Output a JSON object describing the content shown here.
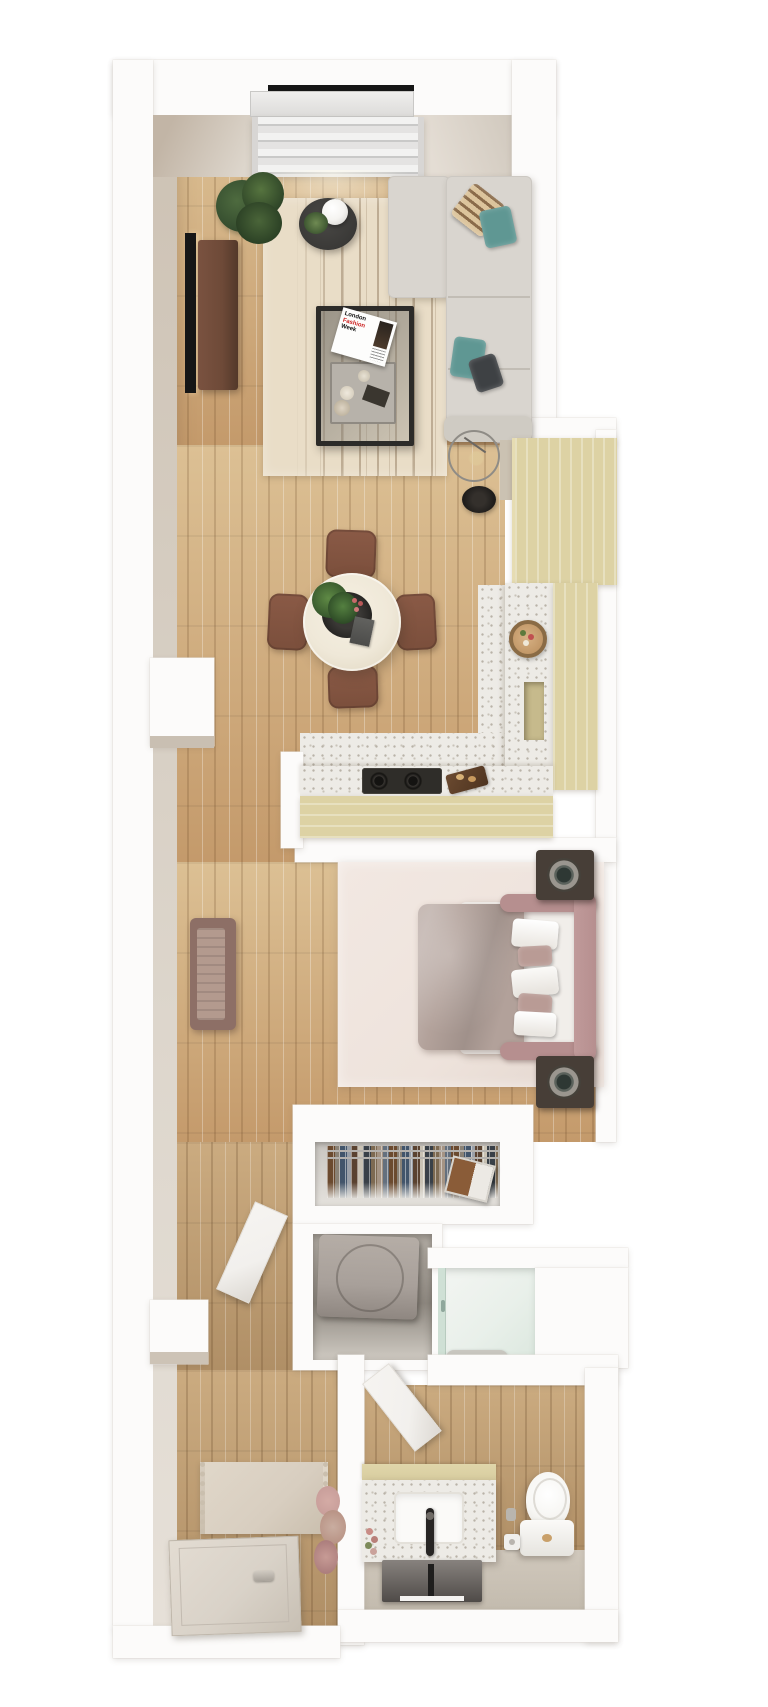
{
  "scene": {
    "description": "3D top-down rendered floor plan of a narrow one-bedroom apartment"
  },
  "magazine": {
    "line1": "London",
    "line2": "Fashion",
    "line3": "Week"
  },
  "colors": {
    "wall": "#fcfbfa",
    "wall_face": "#c2b5a6",
    "wall_face_light": "#ddd6cc",
    "wood_a": "#dcc094",
    "wood_b": "#c49a6b",
    "wood2_a": "#cbab80",
    "wood2_b": "#b08f66",
    "terrazzo": "#edebe6",
    "terrazzo_dot": "#b9b3a8",
    "rug_living": "#e9ddc7",
    "rug_stripe": "#7d6647",
    "sofa": "#d9d5cf",
    "pillow_teal": "#5f9793",
    "pillow_stripe_a": "#dcc49c",
    "pillow_stripe_b": "#8a6b4a",
    "pillow_dark": "#3e4144",
    "side_table": "#3a3937",
    "lamp_white": "#f5f4f1",
    "tv": "#161616",
    "console": "#6e4a38",
    "dining_table": "#efe8d8",
    "chair": "#7b4f3c",
    "cabinet": "#ddd2a4",
    "cabinet_light": "#e6dcb2",
    "cooktop": "#2f2d29",
    "bed_frame": "#b68f8f",
    "duvet": "#b2a19a",
    "sheet": "#f1eeea",
    "pillow_mauve": "#b99b95",
    "rug_bedroom": "#eee3dc",
    "speaker": "#473e37",
    "speaker_cone": "#9a968f",
    "bench": "#8d6f66",
    "bench_top": "#b39a8e",
    "washer": "#a8a09a",
    "shower_glass": "#cfe0d5",
    "shower_floor": "#e9f0ea",
    "mat": "#c9c7c0",
    "bath_floor_low": "#d0c8bc",
    "toilet": "#f7f6f3",
    "mirror_a": "#87827e",
    "mirror_b": "#4f4b48",
    "entry_rug": "#d8cec0",
    "pampas": "#c99f9b",
    "door": "#f2f0ed",
    "entry_door": "#d9d2c8",
    "plant_dark": "#31482c",
    "plant_mid": "#4e6b3f"
  },
  "rooms": [
    {
      "id": "living-room",
      "items": [
        "window-with-blinds",
        "large-plant",
        "round-side-table",
        "sphere-lamp",
        "wall-tv",
        "tv-console",
        "sectional-sofa",
        "throw-pillows",
        "striped-area-rug",
        "glass-coffee-table",
        "magazine",
        "serving-tray",
        "wire-floor-lamp",
        "round-black-mat"
      ]
    },
    {
      "id": "dining-area",
      "items": [
        "round-table",
        "centerpiece-plant",
        "black-tray",
        "dining-chair-x4"
      ]
    },
    {
      "id": "kitchen",
      "items": [
        "tall-cabinet",
        "right-counter",
        "cutting-board-sink",
        "open-niche",
        "cooktop",
        "bread-board"
      ]
    },
    {
      "id": "bedroom",
      "items": [
        "double-bed",
        "bed-frame",
        "duvet",
        "pillows",
        "pink-area-rug",
        "speaker-x2",
        "wall-bench"
      ]
    },
    {
      "id": "closet",
      "items": [
        "hanging-clothes",
        "clothes-rail",
        "storage-box"
      ]
    },
    {
      "id": "laundry-closet",
      "items": [
        "washer"
      ]
    },
    {
      "id": "shower-room",
      "items": [
        "glass-shower",
        "shower-mat"
      ]
    },
    {
      "id": "bathroom",
      "items": [
        "vanity",
        "sink",
        "black-faucet",
        "mirror",
        "toilet",
        "toilet-paper-holder",
        "vase-flowers",
        "swing-door"
      ]
    },
    {
      "id": "entry-hall",
      "items": [
        "fringe-rug",
        "pampas-decor",
        "entry-door",
        "swing-door"
      ]
    }
  ]
}
